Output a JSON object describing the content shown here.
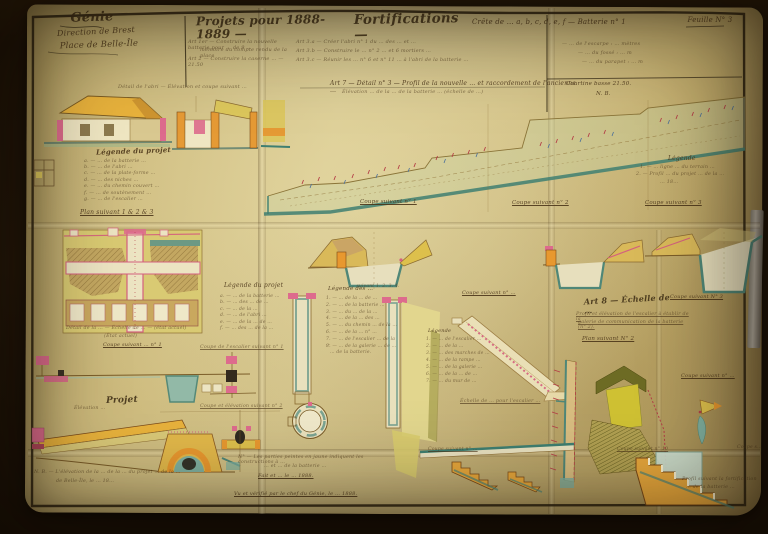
{
  "document_type": "Feuille de projets du Génie (plan manuscrit ancien, 1888-1889)",
  "colors": {
    "backdrop": "#1b1106",
    "paper": "#ccb97a",
    "ink": "#4a3418",
    "ochre_wash": "#e59a35",
    "yellow_wash": "#dcc75c",
    "bright_yellow": "#cfc133",
    "pink_wash": "#dd6b8d",
    "red_marks": "#b43d46",
    "teal_wash": "#4f8778",
    "green_wash": "#c8d3a2",
    "olive_wash": "#6d6b24"
  },
  "texts": {
    "corps": "Génie",
    "direction": "Direction de Brest",
    "place": "Place de Belle-Île",
    "title1": "Projets pour 1888-1889 —",
    "title2": "Fortifications —",
    "title3": "Crête de … a, b, c, d, e, f — Batterie n° 1",
    "sheet": "Feuille N° 3",
    "hn_l1": "Art 1er — Construire la nouvelle batterie pour … de 9 …",
    "hn_l2": "mémoire du compte rendu de la place",
    "hn_l3": "Art 2 — Construire la caserne … — 21.50",
    "hn_m1": "Art 3.a — Créer l'abri n° 1 du … des … et …",
    "hn_m2": "Art 3.b — Construire le … n° 2 … et 6 mortiers …",
    "hn_m3": "Art 3.c — Réunir les … n° 6 et n° 11 … à l'abri de la batterie …",
    "hn_r1": "— … de l'escarpe : … mètres",
    "hn_r2": "— … du fossé : … m",
    "hn_r3": "— … du parapet : … m",
    "hn_r4": "Courtine basse 21.50.",
    "hn_r5": "N. B.",
    "el_caption": "Détail de l'abri — Élévation et coupe suivant …",
    "lg1_t": "Légende du projet",
    "lg1_1": "a. — … de la batterie …",
    "lg1_2": "b. — … de l'abri …",
    "lg1_3": "c. — … de la plate-forme …",
    "lg1_4": "d. — … des niches …",
    "lg1_5": "e. — … du chemin couvert …",
    "lg1_6": "f. — … de soutènement …",
    "lg1_7": "g. — … de l'escalier …",
    "p_title": "Art 7 — Détail n° 3 — Profil de la nouvelle … et raccordement de l'ancienne …",
    "p_sub": "Élévation … de la … de la batterie … (échelle de …)",
    "p_leg_t": "Légende",
    "p_leg_1": "1. — … ligne … du terrain …",
    "p_leg_2": "2. — Profil … du projet … de la …",
    "p_leg_3": "… 18…",
    "p_cut1": "Coupe suivant n° 1",
    "p_cut2": "Coupe suivant n° 2",
    "p_cut3": "Coupe suivant n° 3",
    "plan1_t": "Plan suivant 1 & 2 & 3",
    "lg2_t": "Légende du projet",
    "lg2_1": "a. — … de la batterie …",
    "lg2_2": "b. — … des … de …",
    "lg2_3": "c. — … de la …",
    "lg2_4": "d. — … de l'abri …",
    "lg2_5": "e. — … de la … de …",
    "lg2_6": "f. — … des … de la …",
    "plan1_c1": "Détail de la … — Échelle de … — (état actuel)",
    "plan1_c2": "(État actuel)",
    "bl_cut1": "Coupe suivant … n° 1",
    "bl_cut2": "Coupe de l'escalier suivant n° 1",
    "lg3_t": "Légende des …",
    "lg3_1": "1. — … de la … de …",
    "lg3_2": "2. — … de la batterie …",
    "lg3_3": "3. — … du … de la …",
    "lg3_4": "4. — … de la … des …",
    "lg3_5": "5. — … du chemin … de la …",
    "lg3_6": "6. — … de la … n° …",
    "lg3_7": "7. — … de l'escalier … de la …",
    "lg3_8": "8. — … de la galerie … de …",
    "lg3_9": "… de la batterie.",
    "bl_elev": "Élévation …",
    "bl_projet": "Projet",
    "bl_cut3": "Coupe et élévation suivant n° 2",
    "sec1_cap": "… suivant 1. 2. 3. 4.",
    "cut_mid": "Coupe suivant n° …",
    "st_leg_t": "Légende",
    "st_1": "1. — … de l'escalier …",
    "st_2": "2. — … de la …",
    "st_3": "3. — … des marches de …",
    "st_4": "4. — … de la rampe …",
    "st_5": "5. — … de la galerie …",
    "st_6": "6. — … de la … de …",
    "st_7": "7. — … du mur de …",
    "st_cap": "Échelle de … pour l'escalier …",
    "a8_h": "Art 8 — Échelle de …",
    "a8_1": "Profil et élévation de l'escalier à établir de la",
    "a8_2": "galerie de communication de la batterie (n° 2).",
    "a8_plan": "Plan suivant N° 2",
    "a8_cut": "Coupe suivant N° 3",
    "br_cut9": "Coupe suivant n° …",
    "bc_n1": "N° — Les parties peintes en jaune indiquent les constructions à …",
    "bc_n2": "… et … de la batterie …",
    "bc_n3": "Fait et … le … 1888.",
    "bc_n4": "Vu et vérifié par le chef du Génie, le … 1888.",
    "brb_cutA": "Coupe suivant n° …",
    "brb_cutB": "Coupe suivant n° 10",
    "brb_cutC": "Coupe s…",
    "br_cap1": "Profil suivant la fortification",
    "br_cap2": "… de la batterie …",
    "bl_n1": "N. B. — L'élévation de la … de la … du projet … de la …",
    "bl_n2": "de Belle-Île, le … 18…"
  }
}
